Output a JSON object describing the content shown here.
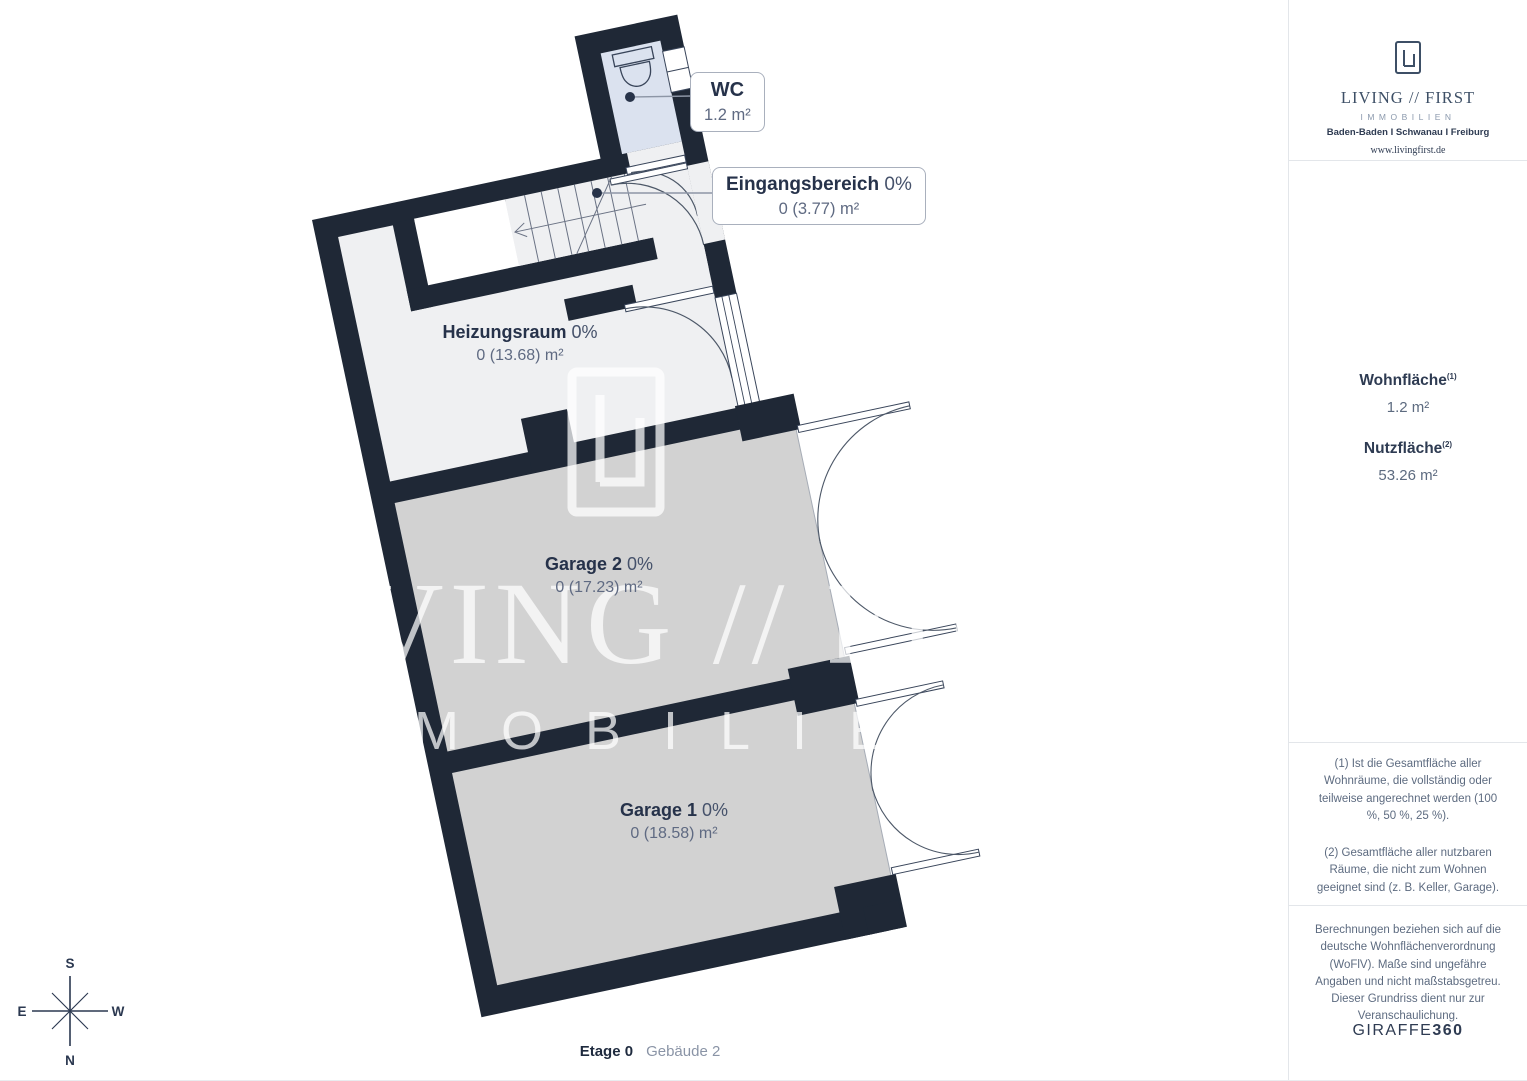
{
  "plan": {
    "rooms": [
      {
        "id": "wc",
        "name": "WC",
        "percent": "",
        "area": "1.2 m²"
      },
      {
        "id": "eingangsbereich",
        "name": "Eingangsbereich",
        "percent": "0%",
        "area": "0 (3.77) m²"
      },
      {
        "id": "heizungsraum",
        "name": "Heizungsraum",
        "percent": "0%",
        "area": "0 (13.68) m²"
      },
      {
        "id": "garage2",
        "name": "Garage 2",
        "percent": "0%",
        "area": "0 (17.23) m²"
      },
      {
        "id": "garage1",
        "name": "Garage 1",
        "percent": "0%",
        "area": "0 (18.58) m²"
      }
    ],
    "compass": {
      "top": "S",
      "bottom": "N",
      "left": "E",
      "right": "W"
    },
    "watermark": {
      "line1": "LIVING // FIRST",
      "line2": "IMMOBILIEN"
    },
    "caption": {
      "floor": "Etage 0",
      "building": "Gebäude 2"
    }
  },
  "sidebar": {
    "logo": {
      "brand": "LIVING // FIRST",
      "sub": "IMMOBILIEN",
      "locations": "Baden-Baden I Schwanau I Freiburg",
      "website": "www.livingfirst.de"
    },
    "areas": {
      "wohnflaeche_label": "Wohnfläche",
      "wohnflaeche_sup": "(1)",
      "wohnflaeche_value": "1.2 m²",
      "nutzflaeche_label": "Nutzfläche",
      "nutzflaeche_sup": "(2)",
      "nutzflaeche_value": "53.26 m²"
    },
    "footnotes": [
      "(1) Ist die Gesamtfläche aller Wohnräume, die vollständig oder teilweise angerechnet werden (100 %, 50 %, 25 %).",
      "(2) Gesamtfläche aller nutzbaren Räume, die nicht zum Wohnen geeignet sind (z. B. Keller, Garage)."
    ],
    "disclaimer": "Berechnungen beziehen sich auf die deutsche Wohnflächenverordnung (WoFlV). Maße sind ungefähre Angaben und nicht maßstabsgetreu. Dieser Grundriss dient nur zur Veranschaulichung.",
    "brandmark": {
      "name": "GIRAFFE",
      "num": "360"
    }
  },
  "colors": {
    "wall": "#1f2836",
    "room_floor": "#eff0f2",
    "wc_floor": "#dbe2ef",
    "garage_floor": "#d2d2d2",
    "brand_navy": "#2e3b52"
  }
}
